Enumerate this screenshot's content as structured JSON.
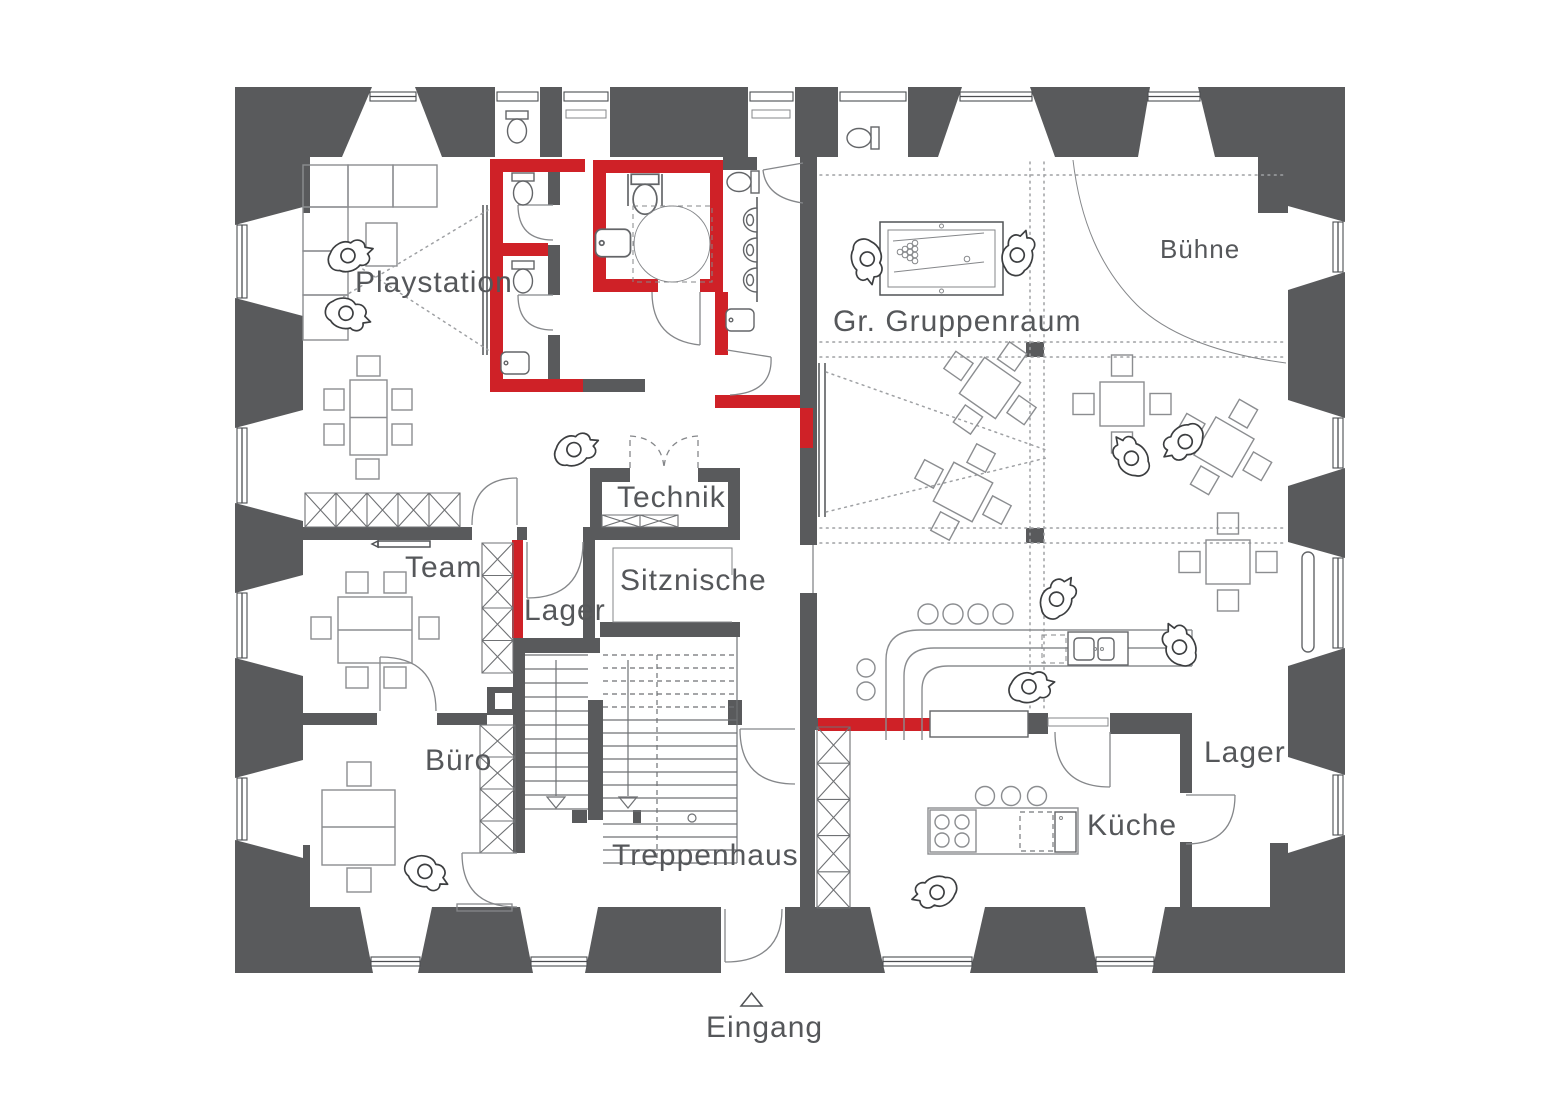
{
  "plan": {
    "language": "de",
    "rooms": [
      {
        "id": "playstation",
        "label": "Playstation"
      },
      {
        "id": "gruppenraum",
        "label": "Gr. Gruppenraum"
      },
      {
        "id": "buehne",
        "label": "Bühne"
      },
      {
        "id": "team",
        "label": "Team"
      },
      {
        "id": "lager_mitte",
        "label": "Lager"
      },
      {
        "id": "technik",
        "label": "Technik"
      },
      {
        "id": "sitznische",
        "label": "Sitznische"
      },
      {
        "id": "buero",
        "label": "Büro"
      },
      {
        "id": "treppenhaus",
        "label": "Treppenhaus"
      },
      {
        "id": "kueche",
        "label": "Küche"
      },
      {
        "id": "lager_rechts",
        "label": "Lager"
      },
      {
        "id": "eingang",
        "label": "Eingang"
      }
    ],
    "icons": {
      "entrance_marker": "triangle-up-icon"
    },
    "colors": {
      "background": "#ffffff",
      "existing_wall": "#595a5c",
      "new_wall_red": "#cf2127",
      "furniture_line": "#8b8d90",
      "fixture_line": "#636568",
      "label_text": "#55575a",
      "dotted_ceiling_line": "#9fa1a4"
    }
  }
}
